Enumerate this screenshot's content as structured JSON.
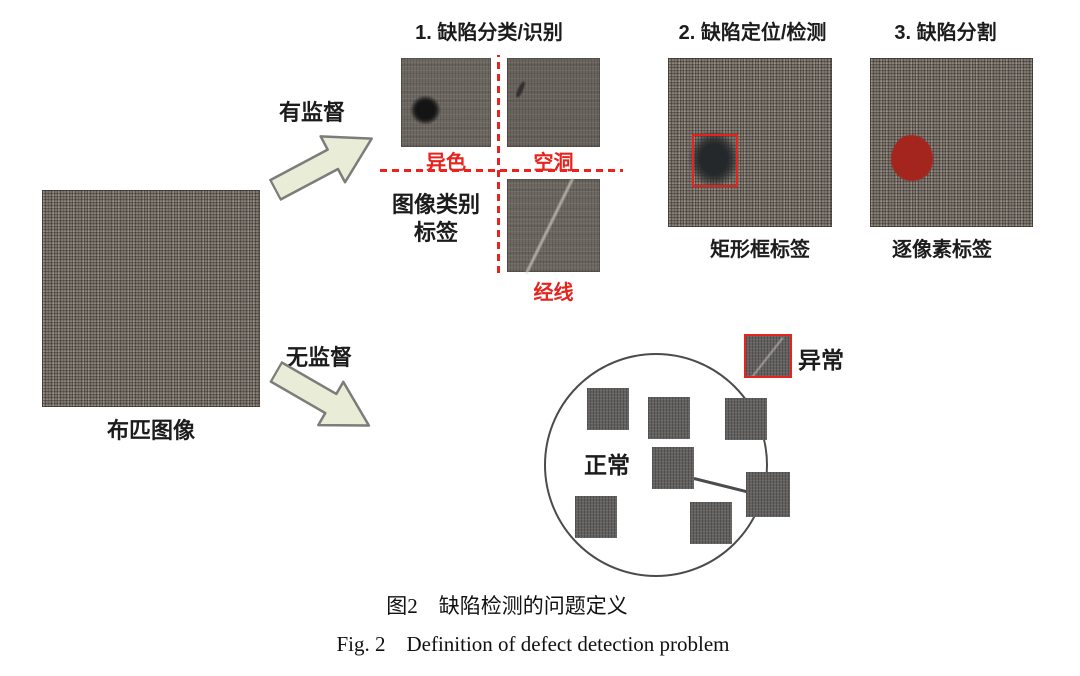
{
  "figure": {
    "source_label": "布匹图像",
    "supervised_label": "有监督",
    "unsupervised_label": "无监督",
    "tasks": [
      {
        "title": "1. 缺陷分类/识别",
        "defect_labels": [
          "异色",
          "空洞",
          "经线"
        ],
        "annotation_lines": [
          "图像类别",
          "标签"
        ]
      },
      {
        "title": "2. 缺陷定位/检测",
        "annotation": "矩形框标签"
      },
      {
        "title": "3. 缺陷分割",
        "annotation": "逐像素标签"
      }
    ],
    "cluster": {
      "normal_label": "正常",
      "abnormal_label": "异常"
    },
    "caption_cn": "图2　缺陷检测的问题定义",
    "caption_en": "Fig. 2　Definition of defect detection problem",
    "colors": {
      "accent_red": "#e8231e",
      "arrow_fill": "#e9ecd7",
      "segmentation_mask_red": "#a3251e"
    }
  }
}
